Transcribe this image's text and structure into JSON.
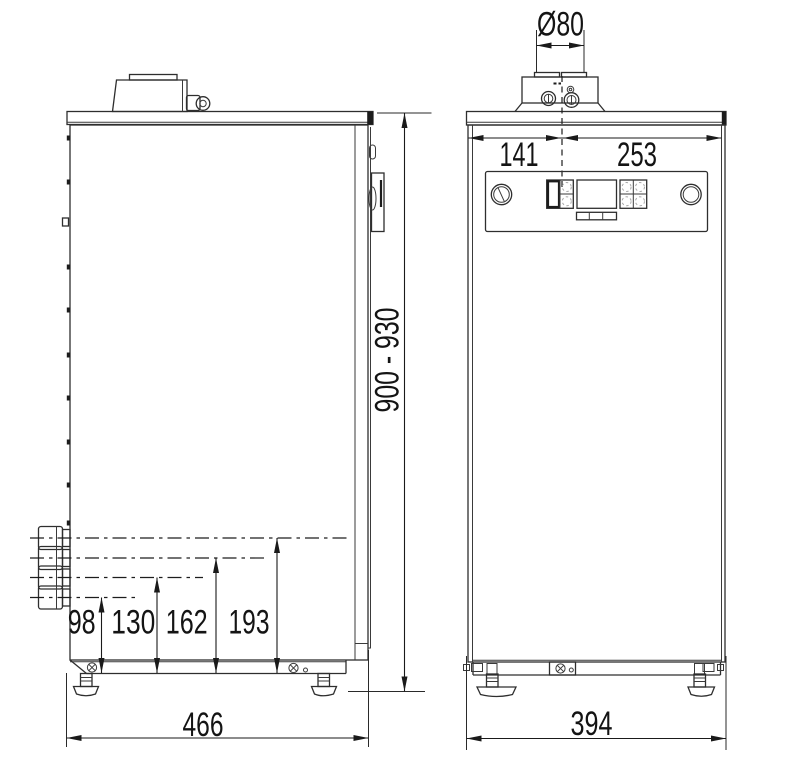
{
  "dimensions": {
    "flue_diameter": "Ø80",
    "flue_center_from_left": "141",
    "flue_center_from_right": "253",
    "overall_height_range": "900 - 930",
    "depth": "466",
    "width": "394",
    "connection_heights": [
      "98",
      "130",
      "162",
      "193"
    ]
  },
  "colors": {
    "background": "#ffffff",
    "part_line": "#2e2e2e",
    "dimension_line": "#1a1a1a",
    "text": "#141414"
  }
}
